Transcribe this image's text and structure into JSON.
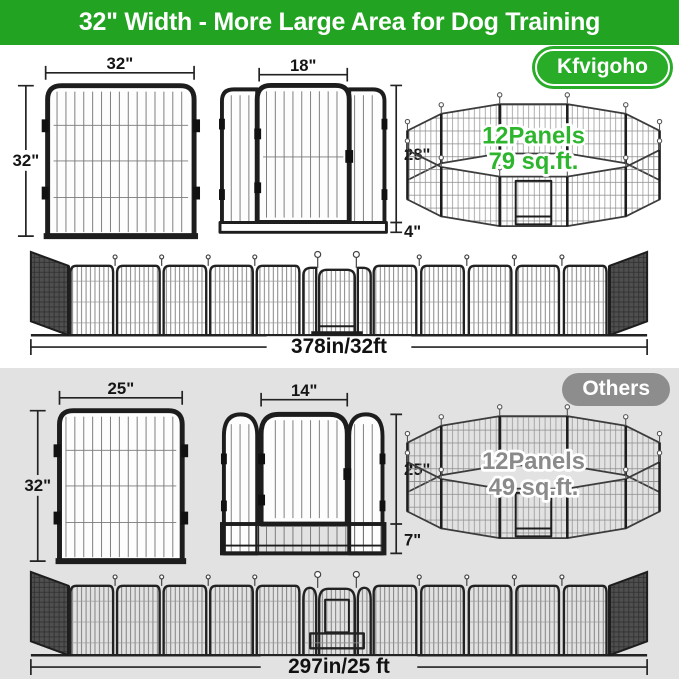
{
  "header": {
    "title": "32\" Width - More Large Area for Dog Training"
  },
  "brand": {
    "badge": "Kfvigoho",
    "panel": {
      "width": "32\"",
      "height": "32\""
    },
    "door": {
      "width": "18\"",
      "height": "28\"",
      "base": "4\""
    },
    "pen": {
      "panels": "12Panels",
      "area": "79 sq.ft."
    },
    "row": {
      "length": "378in/32ft"
    }
  },
  "others": {
    "badge": "Others",
    "panel": {
      "width": "25\"",
      "height": "32\""
    },
    "door": {
      "width": "14\"",
      "height": "25\"",
      "base": "7\""
    },
    "pen": {
      "panels": "12Panels",
      "area": "49 sq.ft."
    },
    "row": {
      "length": "297in/25 ft"
    }
  },
  "colors": {
    "header_green": "#22a322",
    "badge_green": "#29ad29",
    "pen_text_green": "#2db52d",
    "others_gray": "#8d8d8d",
    "section_bg_gray": "#e2e2e2"
  }
}
